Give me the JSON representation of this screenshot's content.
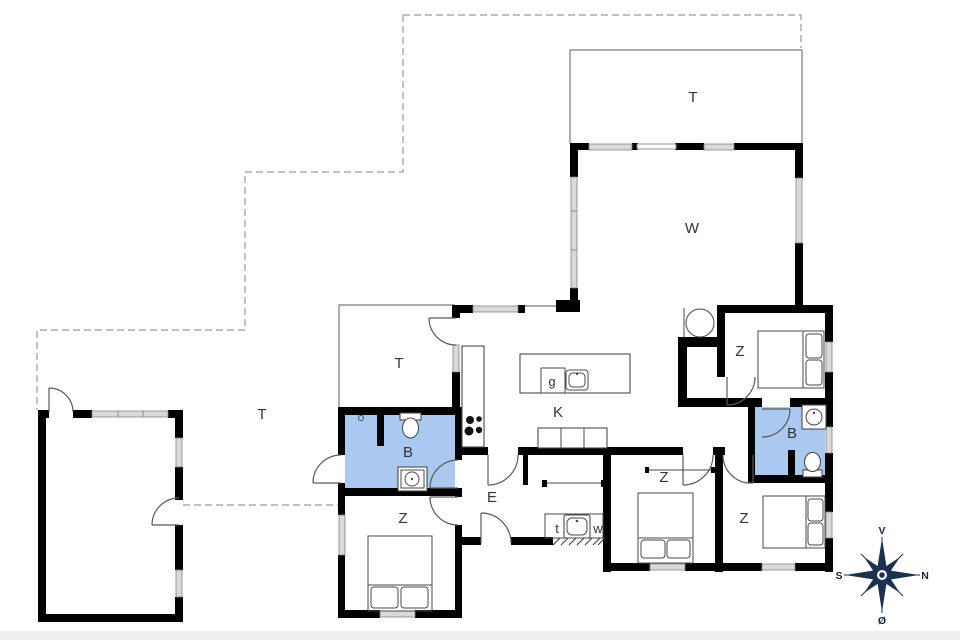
{
  "floorplan": {
    "labels": {
      "terrace_north": "T",
      "terrace_west": "T",
      "terrace_small": "T",
      "living": "W",
      "kitchen": "K",
      "entrance": "E",
      "bath_west": "B",
      "bath_east": "B",
      "bed_ne": "Z",
      "bed_sw": "Z",
      "bed_s": "Z",
      "bed_se": "Z",
      "island_cabinet": "g",
      "tech_room": "t",
      "utility_room": "w"
    },
    "compass": {
      "up": "V",
      "right": "N",
      "left": "S",
      "down": "Ø"
    },
    "colors": {
      "bathroom_fill": "#abc8f0",
      "wall": "#000000",
      "window_fill": "#d9d9d9",
      "compass_navy": "#1e3050",
      "outline": "#555555"
    }
  }
}
